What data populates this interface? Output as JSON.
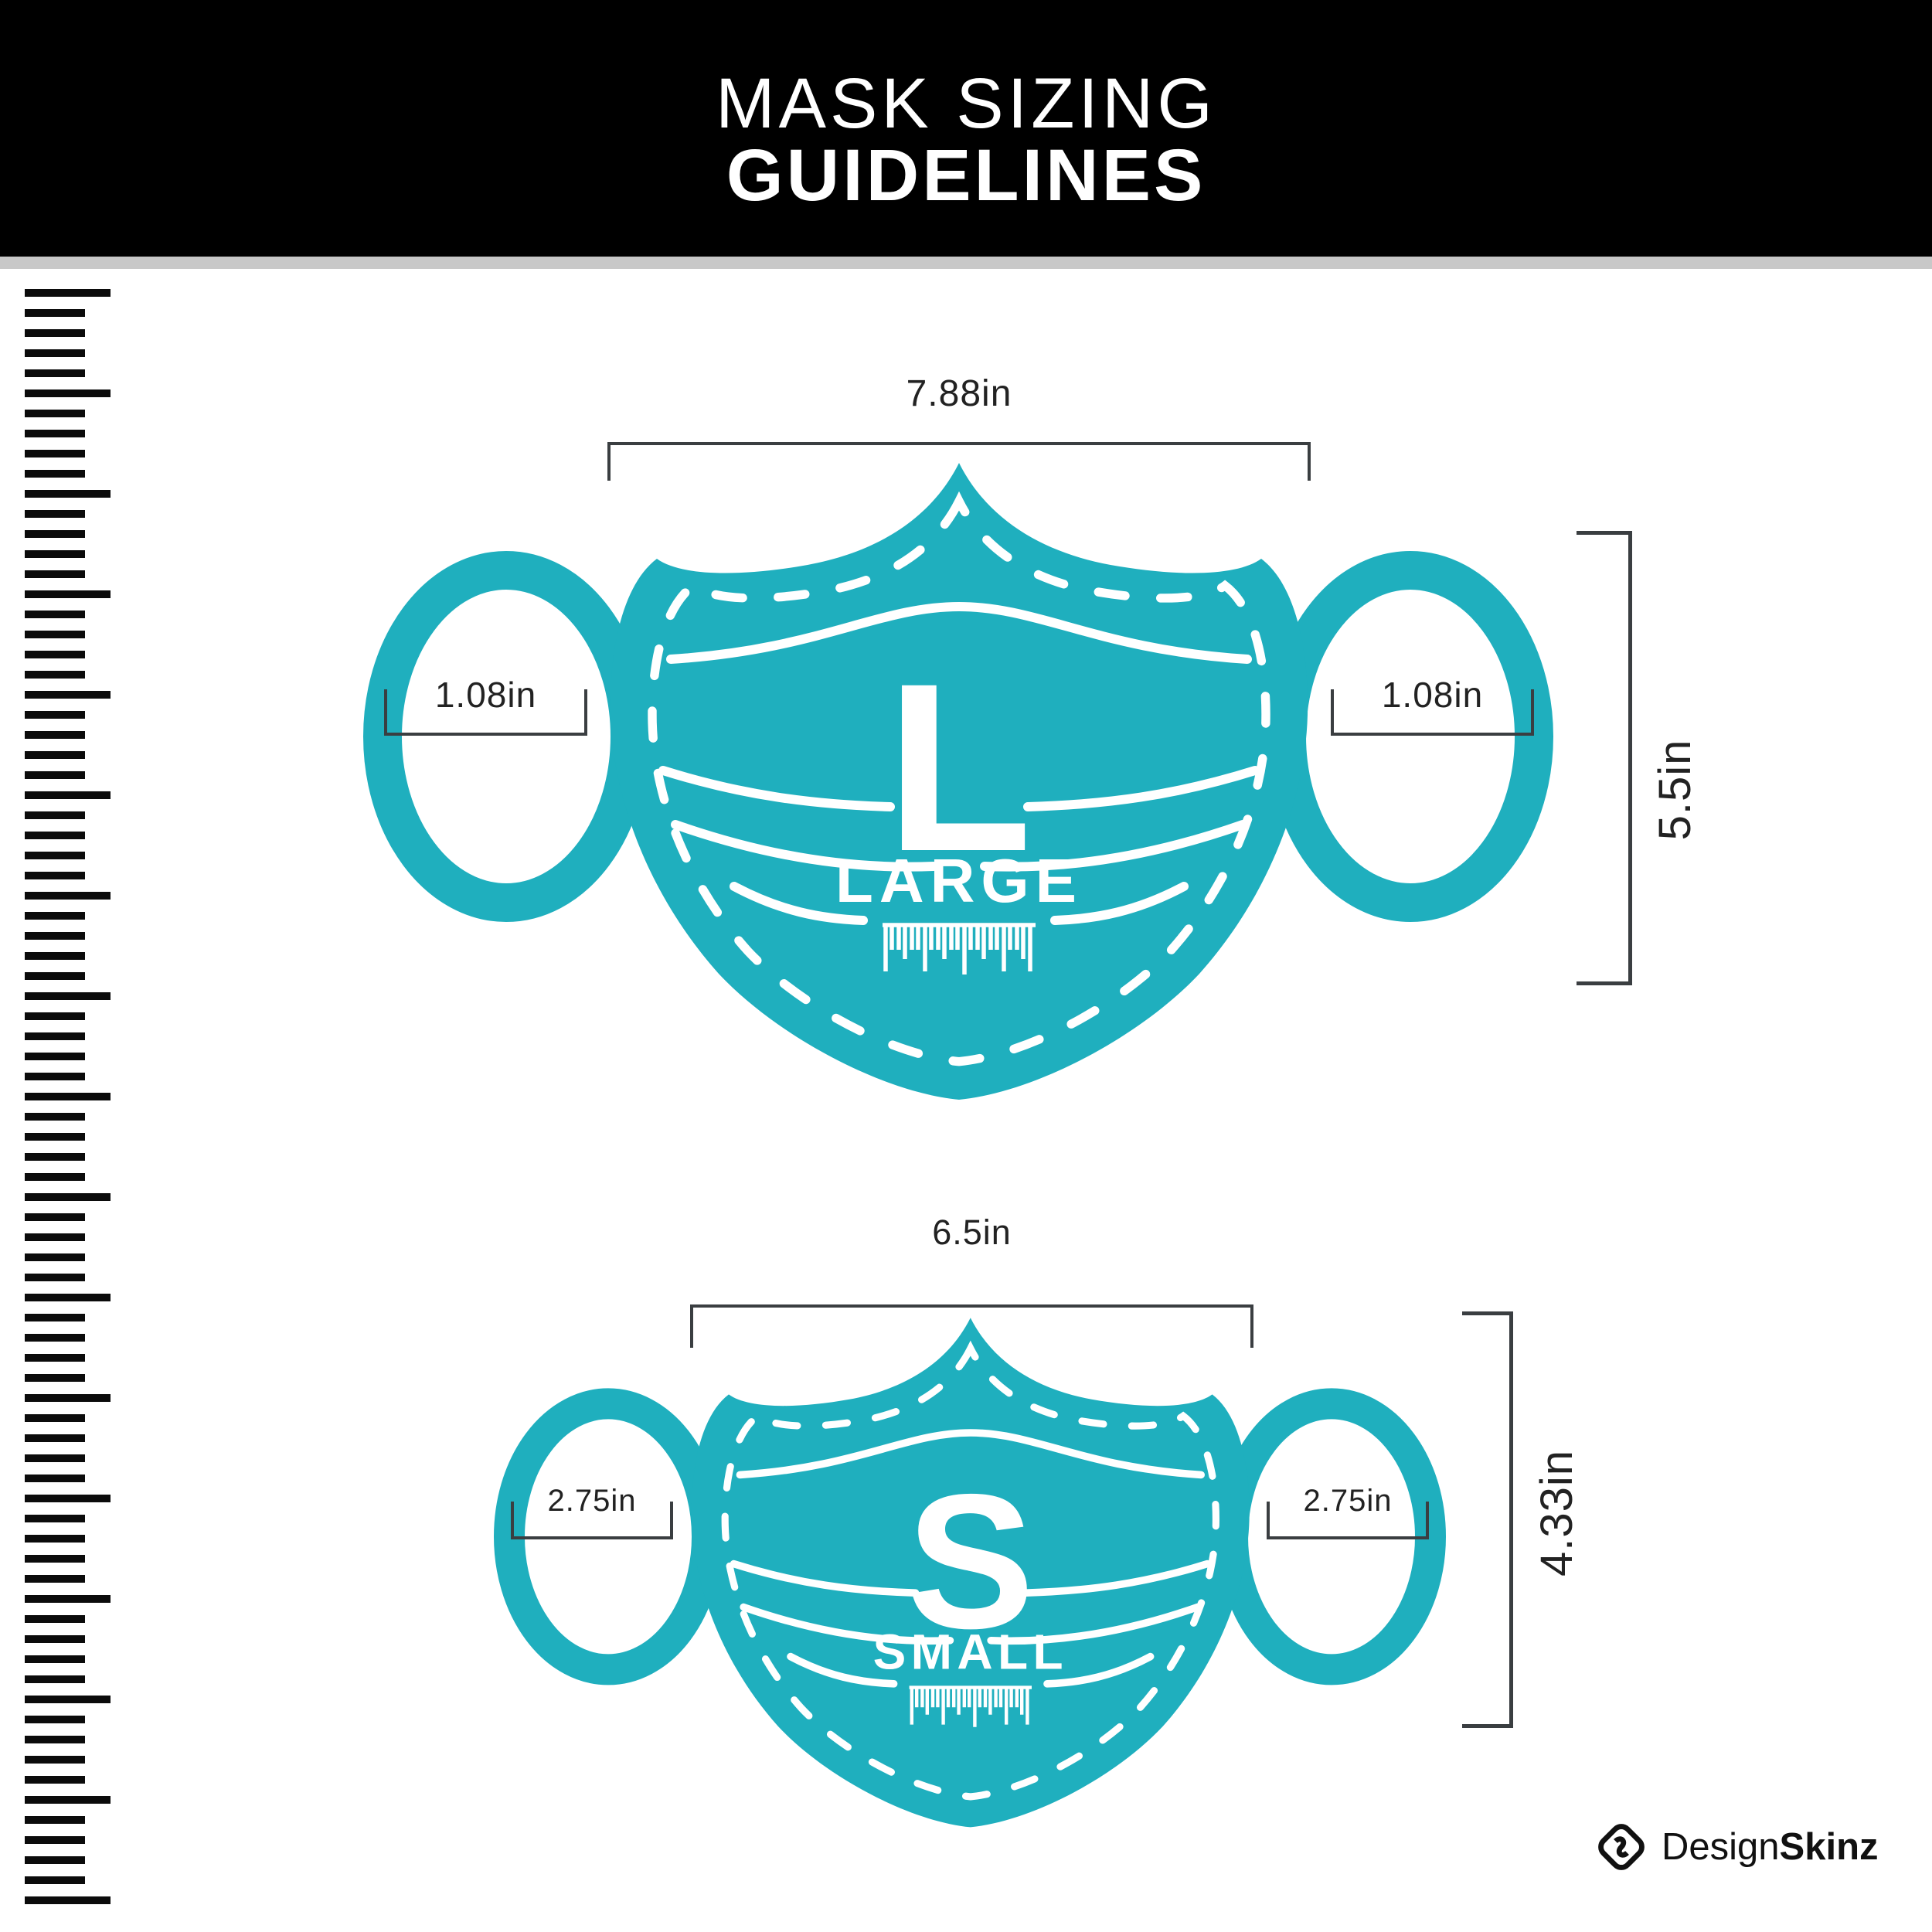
{
  "header": {
    "line1": "MASK SIZING",
    "line2": "GUIDELINES"
  },
  "colors": {
    "teal": "#1FAFBE",
    "header_bg": "#000000",
    "divider": "#C8C8C8",
    "bracket": "#3A3E41",
    "ruler": "#0B0B0B",
    "text": "#222222"
  },
  "ruler": {
    "tick_count": 81,
    "major_every": 5
  },
  "masks": [
    {
      "id": "large",
      "letter": "L",
      "size_word": "LARGE",
      "width": "7.88in",
      "height": "5.5in",
      "ear_left": "1.08in",
      "ear_right": "1.08in"
    },
    {
      "id": "small",
      "letter": "S",
      "size_word": "SMALL",
      "width": "6.5in",
      "height": "4.33in",
      "ear_left": "2.75in",
      "ear_right": "2.75in"
    }
  ],
  "brand": {
    "name_regular": "Design",
    "name_bold": "Skinz"
  }
}
